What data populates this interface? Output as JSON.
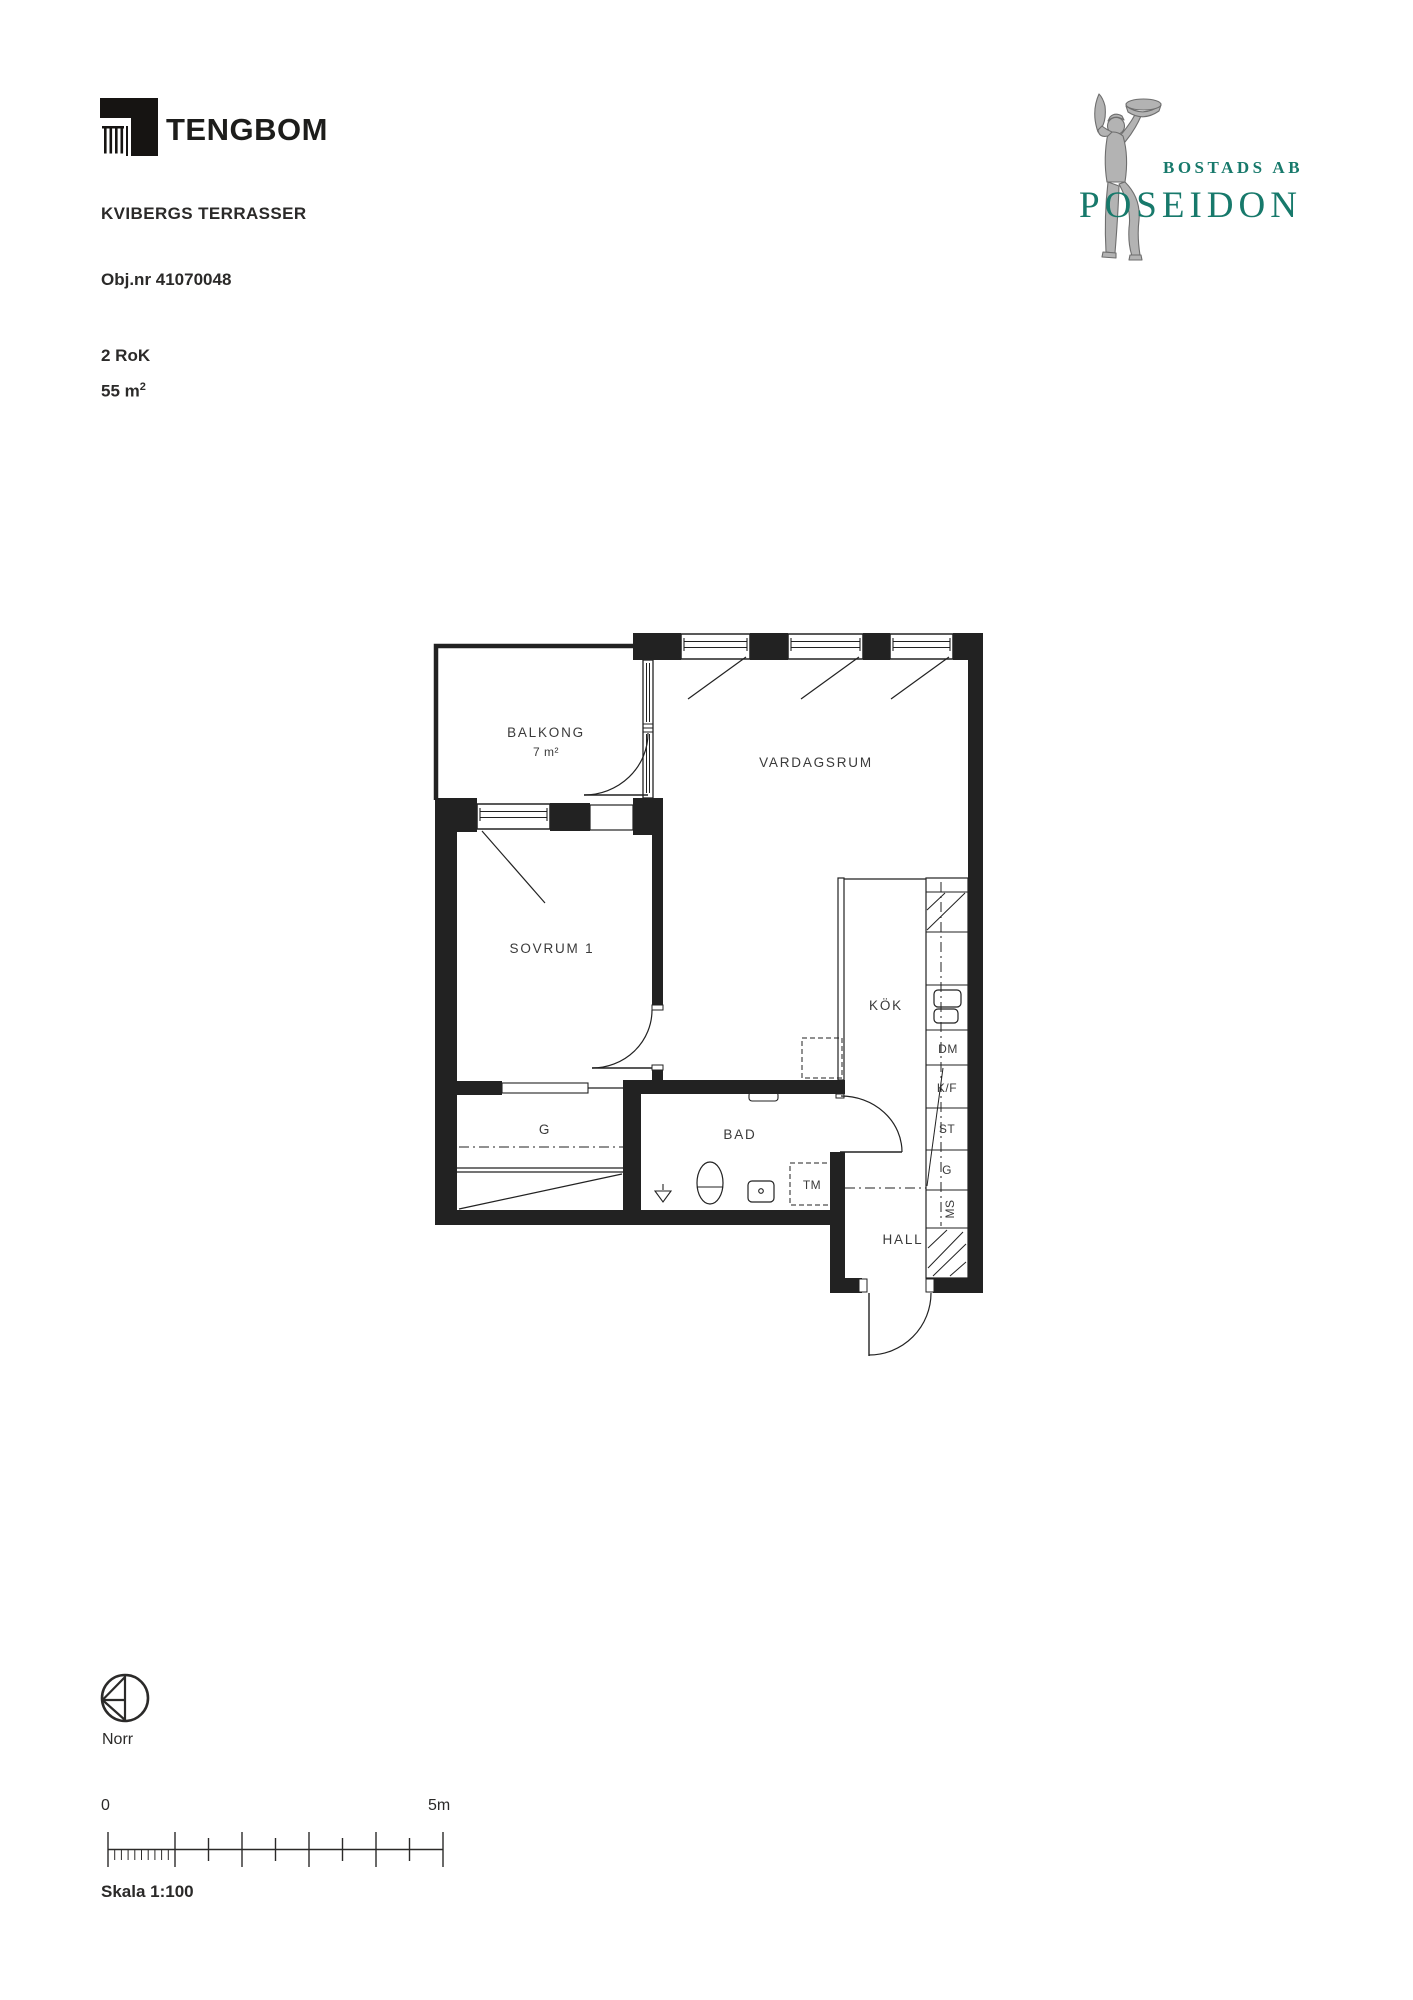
{
  "header": {
    "logo_text": "TENGBOM",
    "project": "KVIBERGS TERRASSER",
    "object_number": "Obj.nr 41070048",
    "rooms": "2 RoK",
    "area": "55 m²"
  },
  "poseidon": {
    "line1": "BOSTADS AB",
    "line2": "POSEIDON",
    "teal": "#17796b"
  },
  "plan": {
    "balkong": "BALKONG",
    "balkong_area": "7 m²",
    "vardagsrum": "VARDAGSRUM",
    "sovrum": "SOVRUM 1",
    "kok": "KÖK",
    "bad": "BAD",
    "hall": "HALL",
    "g_closet": "G",
    "dm": "DM",
    "kf": "K/F",
    "st": "ST",
    "g_cab": "G",
    "ms": "MS",
    "tm": "TM"
  },
  "legend": {
    "north": "Norr",
    "zero": "0",
    "five_m": "5m",
    "scale": "Skala 1:100"
  }
}
